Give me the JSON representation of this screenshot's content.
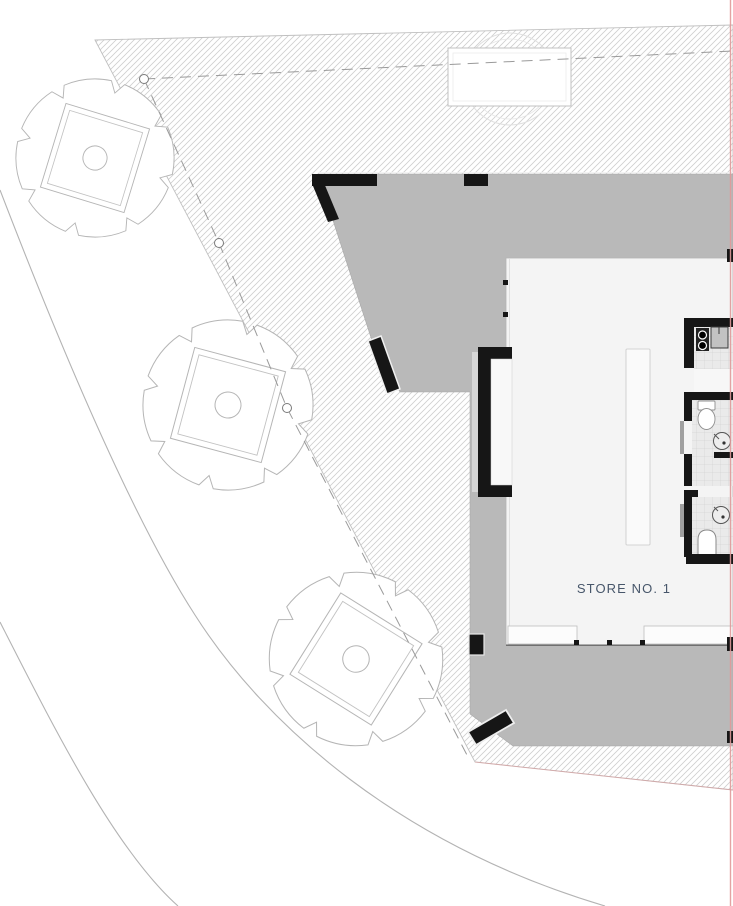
{
  "store": {
    "label": "STORE NO. 1"
  },
  "colors": {
    "canopy_gray": "#b9b9b9",
    "hatch_line": "#cfcfcf",
    "wall_black": "#161616",
    "label_text": "#47566a",
    "boundary_red": "#e09a9a",
    "floor_white": "#f4f4f4",
    "tile_floor": "#eaeaea",
    "outline_gray": "#b5b5b5"
  }
}
